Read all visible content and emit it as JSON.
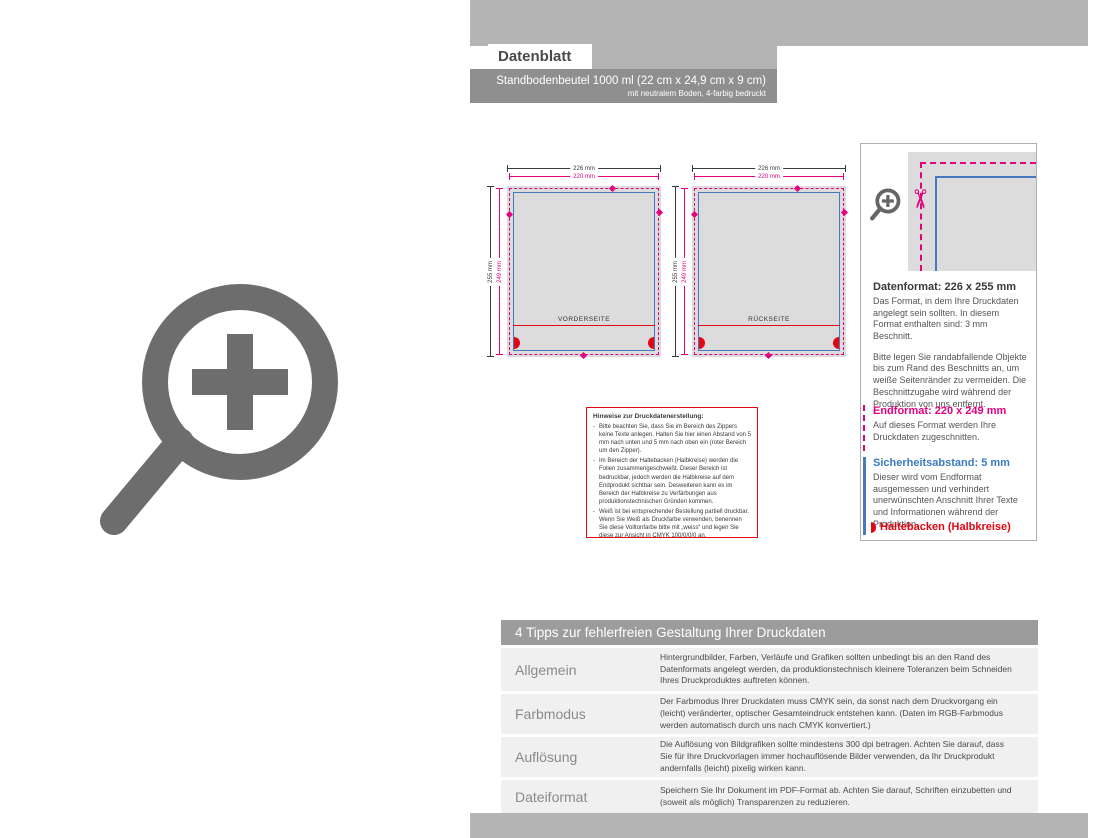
{
  "header": {
    "sheet_label": "Datenblatt",
    "product_title": "Standbodenbeutel 1000 ml (22 cm x 24,9 cm x 9 cm)",
    "product_subtitle": "mit neutralem Boden, 4-farbig bedruckt"
  },
  "diagrams": {
    "front": {
      "label": "VORDERSEITE",
      "width_outer": "226 mm",
      "width_trim": "220 mm",
      "height_outer": "255 mm",
      "height_trim": "249 mm"
    },
    "back": {
      "label": "RÜCKSEITE",
      "width_outer": "226 mm",
      "width_trim": "220 mm",
      "height_outer": "255 mm",
      "height_trim": "249 mm"
    }
  },
  "notes_box": {
    "title": "Hinweise zur Druckdatenerstellung:",
    "bullets": [
      "Bitte beachten Sie, dass Sie im Bereich des Zippers keine Texte anlegen. Halten Sie hier einen Abstand von 5 mm nach unten und 5 mm nach oben ein (roter Bereich um den Zipper).",
      "Im Bereich der Haltebacken (Halbkreise) werden die Folien zusammengeschweißt. Dieser Bereich ist bedruckbar, jedoch werden die Halbkreise auf dem Endprodukt sichtbar sein. Desweiteren kann es im Bereich der Halbkreise zu Verfärbungen aus produktionstechnischen Gründen kommen.",
      "Weiß ist bei entsprechender Bestellung partiell druckbar. Wenn Sie Weiß als Druckfarbe verwenden, benennen Sie diese Volltonfarbe bitte mit „weiss“ und legen Sie diese zur Ansicht in CMYK 100/0/0/0 an."
    ]
  },
  "info_panel": {
    "datenformat": {
      "heading": "Datenformat: 226 x 255 mm",
      "p1": "Das Format, in dem Ihre Druckdaten angelegt sein sollten. In diesem Format enthalten sind: 3 mm Beschnitt.",
      "p2": "Bitte legen Sie randabfallende Objekte bis zum Rand des Beschnitts an, um weiße Seitenränder zu vermeiden. Die Beschnittzugabe wird während der Produktion von uns entfernt."
    },
    "endformat": {
      "heading": "Endformat: 220 x 249 mm",
      "p1": "Auf dieses Format werden Ihre Druckdaten zugeschnitten."
    },
    "sicherheitsabstand": {
      "heading": "Sicherheitsabstand: 5 mm",
      "p1": "Dieser wird vom Endformat ausgemessen und verhindert unerwünschten Anschnitt Ihrer Texte und Informationen während der Produktion."
    },
    "legend": "Haltebacken (Halbkreise)"
  },
  "tips_table": {
    "title": "4 Tipps zur fehlerfreien Gestaltung Ihrer Druckdaten",
    "rows": [
      {
        "label": "Allgemein",
        "text": "Hintergrundbilder, Farben, Verläufe und Grafiken sollten unbedingt bis an den Rand des Datenformats angelegt werden, da produktionstechnisch kleinere Toleranzen beim Schneiden Ihres Druckproduktes auftreten können."
      },
      {
        "label": "Farbmodus",
        "text": "Der Farbmodus Ihrer Druckdaten muss CMYK sein, da sonst nach dem Druckvorgang ein (leicht) veränderter, optischer Gesamteindruck entstehen kann. (Daten im RGB-Farbmodus werden automatisch durch uns nach CMYK konvertiert.)"
      },
      {
        "label": "Auflösung",
        "text": "Die Auflösung von Bildgrafiken sollte mindestens 300 dpi betragen. Achten Sie darauf, dass Sie für Ihre Druckvorlagen immer hochauflösende Bilder verwenden, da Ihr Druckprodukt andernfalls (leicht) pixelig wirken kann."
      },
      {
        "label": "Dateiformat",
        "text": "Speichern Sie Ihr Dokument im PDF-Format ab. Achten Sie darauf, Schriften einzubetten und (soweit als möglich) Transparenzen zu reduzieren."
      }
    ]
  },
  "icons": {
    "scissors_glyph": "✂"
  },
  "colors": {
    "magenta": "#e6007e",
    "blue": "#4679bd",
    "red": "#e30613",
    "strip_gray": "#b4b4b4",
    "bar_gray": "#8f8f8f",
    "diagram_fill": "#dcdcdc"
  }
}
